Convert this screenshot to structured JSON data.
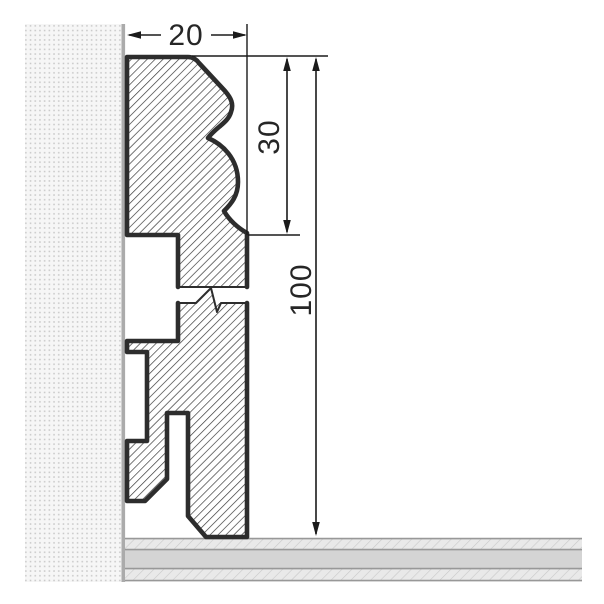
{
  "drawing": {
    "kind": "skirting-board-cross-section",
    "dimensions": {
      "width": {
        "label": "20"
      },
      "upper_height": {
        "label": "30"
      },
      "overall_height": {
        "label": "100"
      }
    },
    "elements": {
      "wall": "wall with stipple render",
      "floor": "layered floor build-up",
      "profile": "hatched skirting profile with break line"
    },
    "colors": {
      "background": "#ffffff",
      "profile_outline": "#2d2d2d",
      "profile_hatch": "#3c3c3c",
      "dimension_lines": "#1b1b1b",
      "wall_fill": "#f6f6f6",
      "wall_dots": "#c7c7c7",
      "wall_edge": "#ababab",
      "floor_core": "#d4d4d4",
      "floor_hatch_fill": "#e9e9e9",
      "floor_hatch_lines": "#c9c9c9",
      "floor_lines": "#989898"
    }
  }
}
